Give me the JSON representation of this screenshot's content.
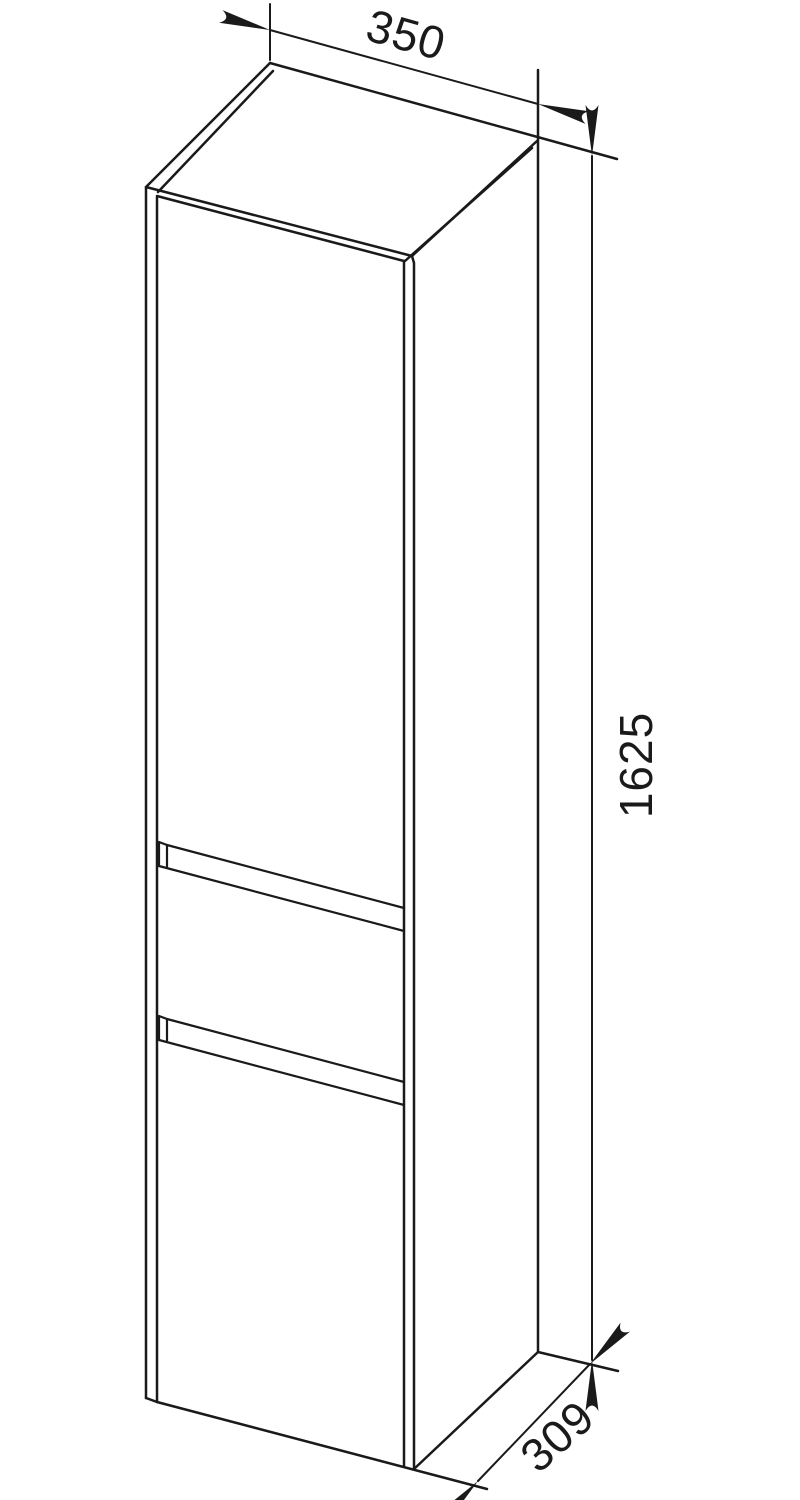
{
  "page": {
    "background_color": "#ffffff"
  },
  "drawing": {
    "kind": "technical dimension drawing",
    "subject": "tall cabinet with upper door, middle drawer front and lower door, three-quarter perspective line art",
    "line_color": "#1a1a1a",
    "dimensions": {
      "width": "350",
      "height": "1625",
      "depth": "309"
    }
  }
}
